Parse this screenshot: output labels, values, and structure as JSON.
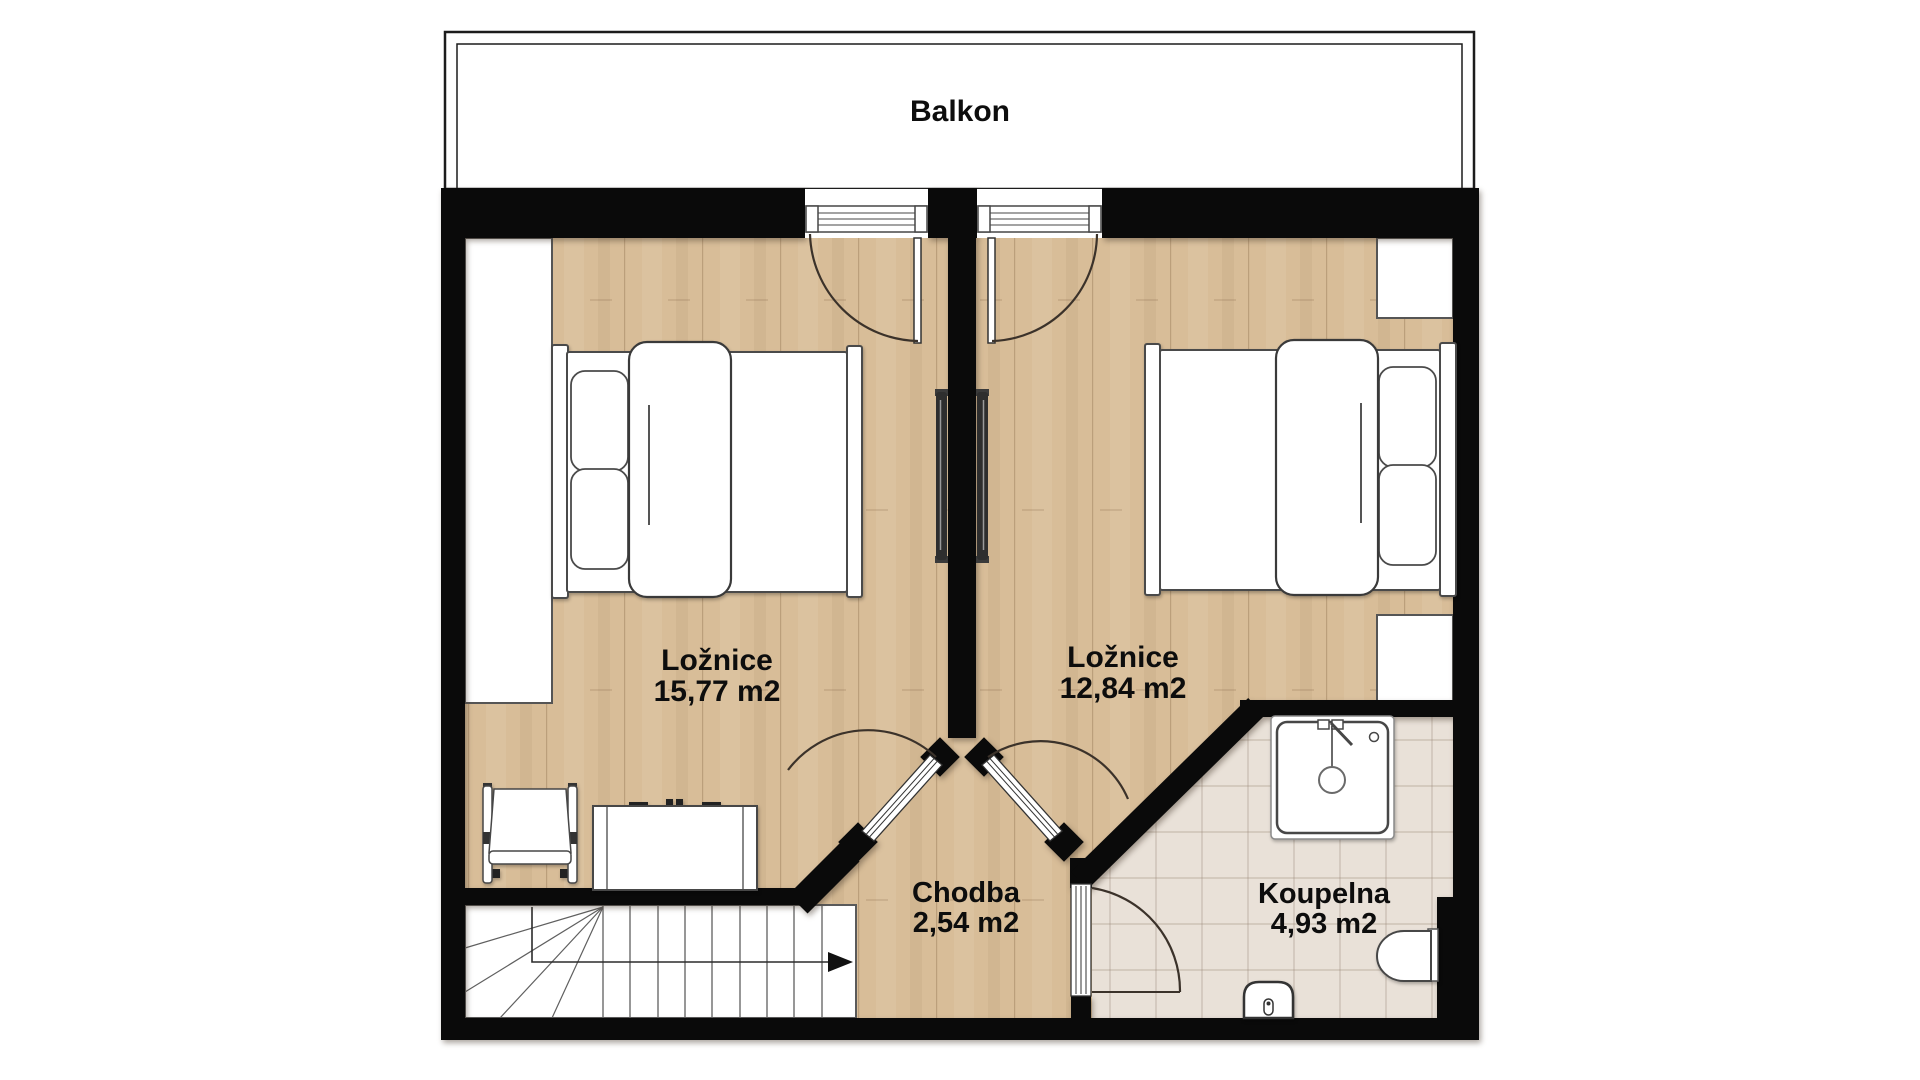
{
  "title": "Floor plan - upper floor",
  "floorplan": {
    "balcony": {
      "label": "Balkon"
    },
    "rooms": [
      {
        "id": "bedroom-left",
        "name": "Ložnice",
        "area": "15,77 m2"
      },
      {
        "id": "bedroom-right",
        "name": "Ložnice",
        "area": "12,84 m2"
      },
      {
        "id": "hallway",
        "name": "Chodba",
        "area": "2,54 m2"
      },
      {
        "id": "bathroom",
        "name": "Koupelna",
        "area": "4,93 m2"
      }
    ],
    "fixtures": [
      "double-bed",
      "double-bed",
      "wardrobe",
      "wardrobe",
      "wardrobe",
      "tv",
      "tv",
      "armchair",
      "dresser",
      "shower",
      "toilet",
      "sink",
      "staircase"
    ],
    "colors": {
      "wall": "#0a0a0a",
      "wood_floor": "#d8bd98",
      "tile_floor": "#e9e1d8",
      "outline": "#474747",
      "text": "#0d0d0d",
      "background": "#ffffff"
    }
  }
}
